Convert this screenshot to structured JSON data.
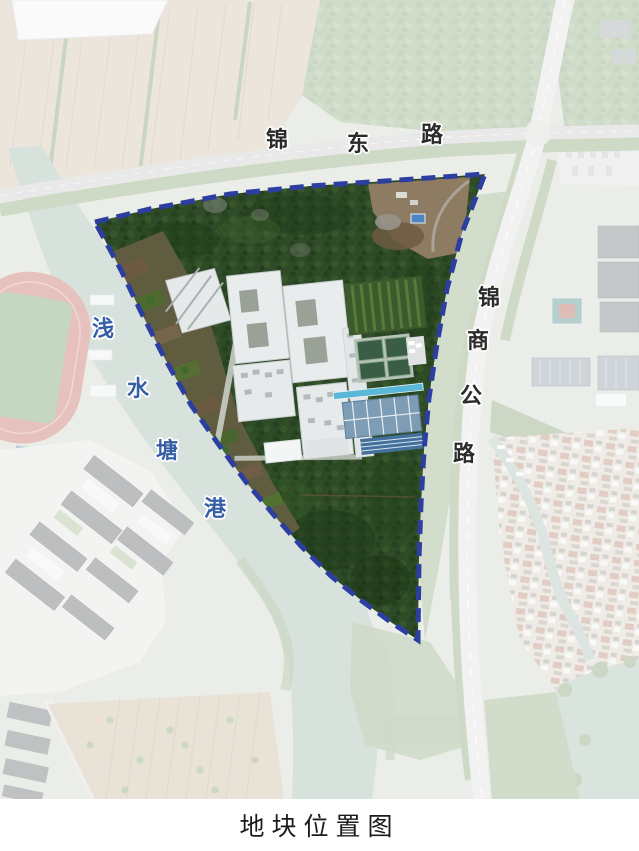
{
  "title": "地块位置图",
  "map": {
    "labels": {
      "road_top": {
        "name": "锦东路",
        "chars": [
          "锦",
          "东",
          "路"
        ]
      },
      "road_right": {
        "name": "锦商公路",
        "chars": [
          "锦",
          "商",
          "公",
          "路"
        ]
      },
      "river": {
        "name": "浅水塘港",
        "chars": [
          "浅",
          "水",
          "塘",
          "港"
        ]
      }
    },
    "site_boundary": {
      "shape": "triangular plot outlined with dashed line",
      "color": "#2c3fa0"
    },
    "colors": {
      "boundary_dash": "#2c3fa0",
      "road_label_text": "#2b2b2b",
      "river_label_text": "#365ea6",
      "title_text": "#1b1b1b",
      "site_forest": "#2e4a27",
      "sports_court": "#3a5e45",
      "warehouse_roof": "#7d9cb5",
      "running_track": "#c4645a",
      "river_water": "#9fb6ab"
    }
  }
}
